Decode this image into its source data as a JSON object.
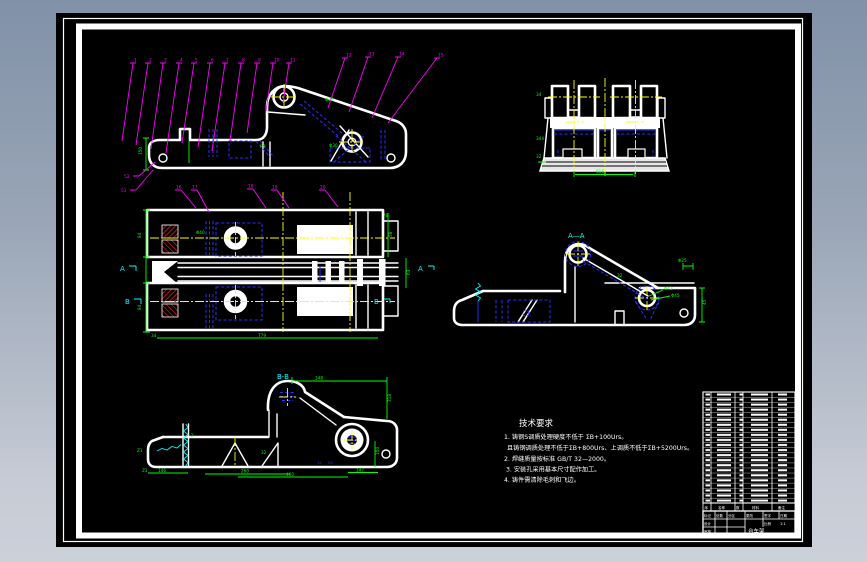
{
  "colors": {
    "background_top": "#8191a8",
    "background_bottom": "#ccd0d9",
    "canvas": "#000000",
    "outline": "#ffffff",
    "dimension": "#00ff00",
    "leader": "#ff00ff",
    "centerline": "#ffff00",
    "hidden_line": "#2b2bff",
    "section_mark": "#00ffff",
    "hatch": "#ff2222"
  },
  "sections": {
    "aa": "A—A",
    "bb": "B-B",
    "a": "A",
    "b": "B"
  },
  "callouts": {
    "v1l": [
      "1",
      "2",
      "3",
      "4",
      "5",
      "6",
      "7",
      "8",
      "9",
      "10",
      "11"
    ],
    "v1r": [
      "12",
      "13",
      "14",
      "15"
    ],
    "v1s": [
      "51",
      "52"
    ],
    "plan": [
      "16",
      "17",
      "18",
      "19",
      "20"
    ]
  },
  "dims": {
    "view1": {
      "left_height": "150",
      "fillet": "R8",
      "hub_top": "Φ25",
      "hub_mid": "Φ30"
    },
    "end_view": {
      "bottom_width": "616",
      "l1": "34",
      "l2": "344",
      "l3": "32"
    },
    "plan": {
      "left_upper": "84",
      "left_lower": "84",
      "right_rail": "58",
      "spine": "63",
      "corner": "34",
      "bottom_length": "779",
      "top_right": "78",
      "hub": "Φ40"
    },
    "aa": {
      "right_height": "45",
      "top_right": "Φ25",
      "web": "32",
      "hub1": "Φ43",
      "hub2": "Φ45"
    },
    "bb": {
      "top_width": "348",
      "right_height": "318",
      "inner_height": "104",
      "b1": "146",
      "b2": "260",
      "b3": "400",
      "b4": "147",
      "z1": "Z1",
      "z2": "Z1",
      "z3": "2",
      "web": "32",
      "r1": "12",
      "r2": "R2"
    }
  },
  "notes": {
    "title": "技术要求",
    "lines": [
      "1. 铸钢S调质处理硬度不低于 ΣB+100Urs。",
      "且铸钢调质处理不低于ΣB+800Urs、上调质不低于ΣB+5200Urs。",
      "2. 焊缝质量按标准 GB/T 32—2000。",
      "3. 安装孔采用基本尺寸配作加工。",
      "4. 铸件需清除毛刺和飞边。"
    ]
  },
  "bom": {
    "row_count": 22,
    "headers": [
      "序",
      "名称",
      "数",
      "材料",
      "备注"
    ]
  },
  "title_block": {
    "r1": [
      "标记",
      "处数",
      "分区",
      "更改",
      "签字",
      "日期"
    ],
    "design": "设计",
    "check": "审核",
    "center": "台车架",
    "scale": "比例",
    "sheet": "1:1"
  }
}
